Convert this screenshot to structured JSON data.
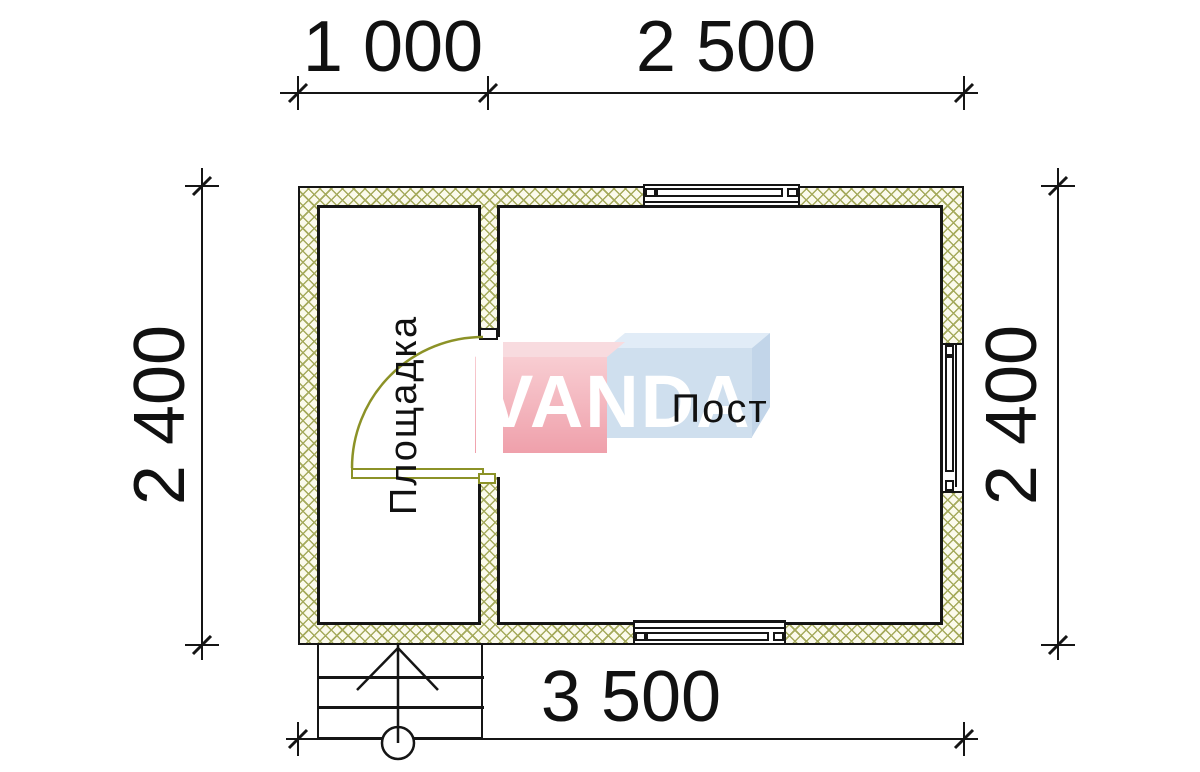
{
  "labels": {
    "dim_top_left": "1 000",
    "dim_top_right": "2 500",
    "dim_bottom": "3 500",
    "dim_left": "2 400",
    "dim_right": "2 400"
  },
  "rooms": [
    {
      "name": "Площадка"
    },
    {
      "name": "Пост"
    }
  ],
  "watermark": {
    "text": "VANDA",
    "pink": "#efa3ad",
    "pink_light": "#f8dbdf",
    "blue": "#cfdfee",
    "blue_light": "#e1ecf7",
    "blue_side": "#c2d5e9"
  },
  "colors": {
    "wall_line": "#151515",
    "hatch_line": "#a5aa5c",
    "hatch_bg": "#fbfaec",
    "door": "#8c9227",
    "text": "#111111"
  },
  "plan": {
    "total_width_mm": 3500,
    "total_depth_mm": 2400,
    "segments_top_mm": [
      1000,
      2500
    ]
  }
}
